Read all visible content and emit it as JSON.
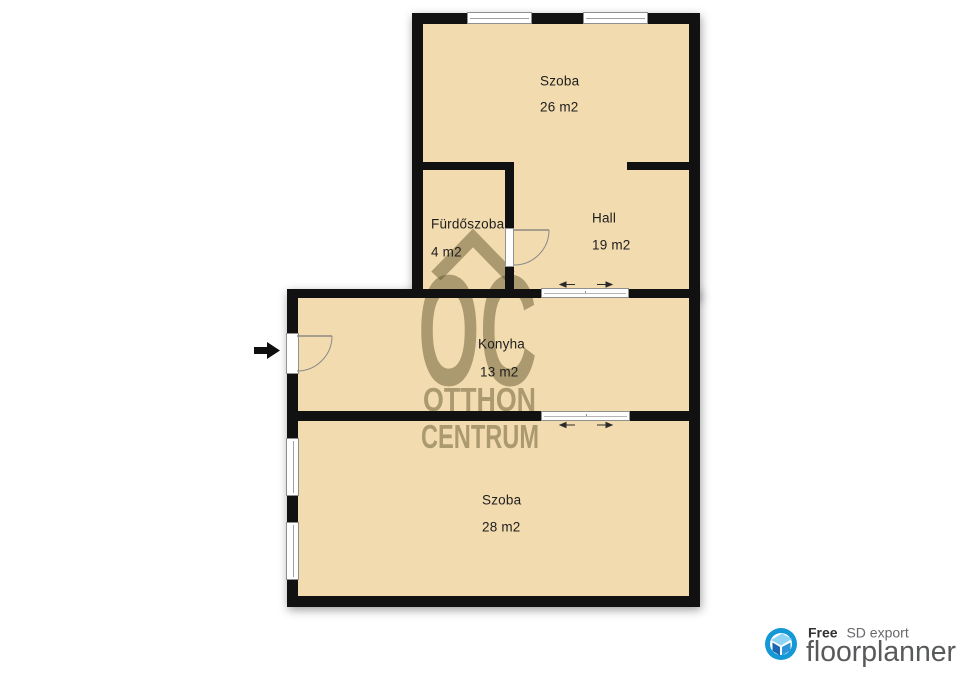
{
  "plan": {
    "rooms": [
      {
        "name": "Szoba",
        "area": "26 m2"
      },
      {
        "name": "Fürdőszoba",
        "area": "4 m2"
      },
      {
        "name": "Hall",
        "area": "19 m2"
      },
      {
        "name": "Konyha",
        "area": "13 m2"
      },
      {
        "name": "Szoba",
        "area": "28 m2"
      }
    ],
    "colors": {
      "room_fill": "#f2dbae",
      "wall": "#111111",
      "outside": "#ffffff",
      "label_text": "#1e1e1e",
      "watermark": "rgba(100,88,48,0.5)"
    }
  },
  "watermark": {
    "monogram": "OC",
    "line1": "OTTHON",
    "line2": "CENTRUM"
  },
  "footer": {
    "free_label": "Free",
    "export_label": "SD export",
    "brand": "floorplanner",
    "brand_color": "#58595b",
    "free_color": "#323234",
    "export_color": "#66676b",
    "circle_color": "#1598d6",
    "house_light": "#8ed4f5",
    "house_dark": "#1b66ad",
    "house_mid": "#2e96d8"
  }
}
